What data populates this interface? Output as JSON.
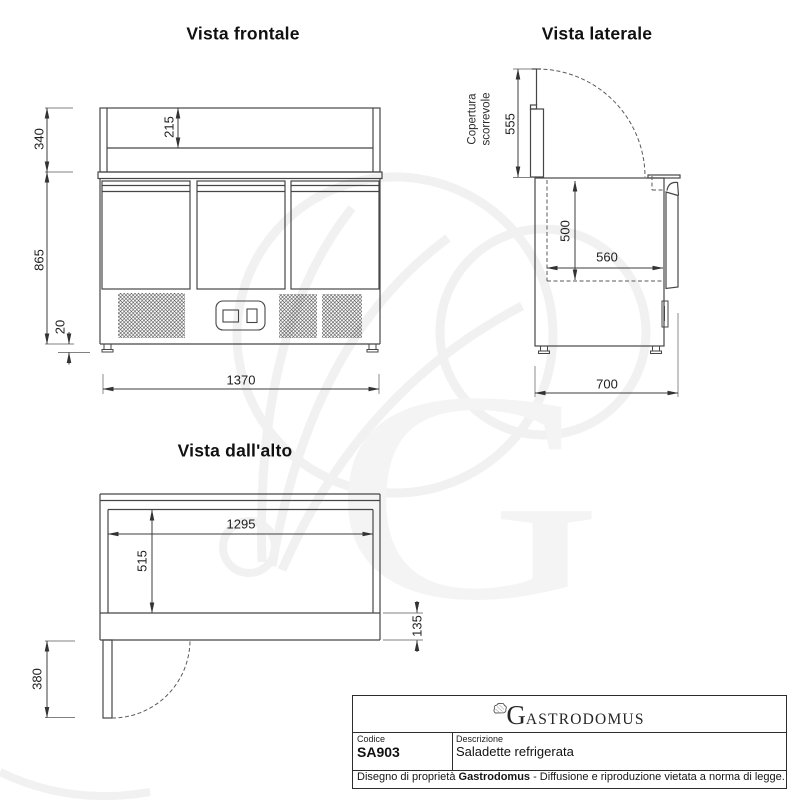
{
  "views": {
    "front": {
      "title": "Vista frontale",
      "dims": {
        "top_section_height": "340",
        "display_inner_height": "215",
        "body_height": "865",
        "feet_height": "20",
        "total_width": "1370"
      }
    },
    "side": {
      "title": "Vista laterale",
      "cover_label": [
        "Copertura",
        "scorrevole"
      ],
      "dims": {
        "cover_height": "555",
        "inner_height": "500",
        "inner_depth": "560",
        "total_depth": "700"
      }
    },
    "top": {
      "title": "Vista dall'alto",
      "dims": {
        "inner_width": "1295",
        "inner_depth": "515",
        "front_edge_depth": "135",
        "door_swing": "380"
      }
    }
  },
  "title_block": {
    "brand_initial": "G",
    "brand_rest": "ASTRODOMUS",
    "code_label": "Codice",
    "code_value": "SA903",
    "description_label": "Descrizione",
    "description_value": "Saladette refrigerata",
    "footer_prefix": "Disegno di proprietà ",
    "footer_brand": "Gastrodomus",
    "footer_suffix": " - Diffusione e riproduzione vietata a norma di legge."
  },
  "watermark": {
    "letter": "G"
  },
  "colors": {
    "drawing_line": "#464646",
    "dimension_line": "#3d3d3d",
    "extension_line": "#808080",
    "watermark": "#f2f2f2",
    "text": "#1c1c1c",
    "background": "#ffffff"
  }
}
